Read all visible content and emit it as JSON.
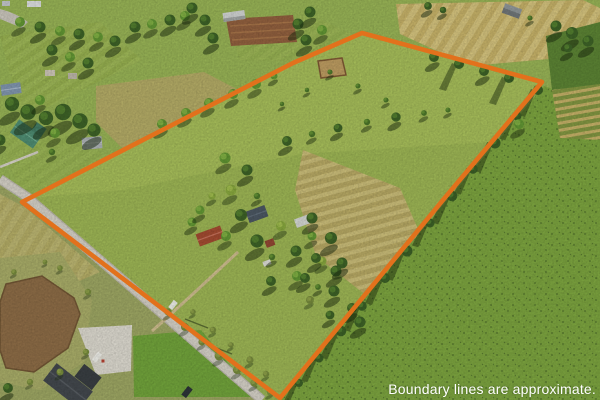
{
  "overlay": {
    "disclaimer": "Boundary lines are approximate.",
    "disclaimer_color": "#ffffff",
    "boundary_color": "#e2711c"
  },
  "scene": {
    "type": "aerial-drone-photograph",
    "subject": "rural farm parcel outlined with orange property-boundary lines",
    "palette": {
      "pasture_green_inside": "#9ab253",
      "pasture_green_outside": "#7aa13e",
      "stubble_tan": "#c8b66f",
      "plowed_dirt_brown": "#8e5e3d",
      "pond_brown": "#8a6a45",
      "road_gray": "#d0ccc2",
      "tree_dark_green": "#3c6026"
    }
  }
}
